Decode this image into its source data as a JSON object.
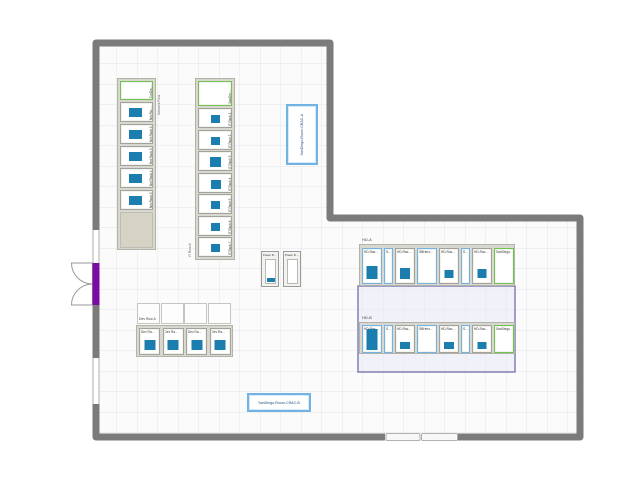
{
  "cracs": {
    "a": "SanDiego-Room-CRAC-A",
    "b": "SanDiego-Room-CRAC-B"
  },
  "network_row": {
    "title": "Network Row",
    "header": "CorDis…",
    "racks": [
      "Net Ra…",
      "Net Rack 2",
      "Net Rack 3",
      "Net Rack 4",
      "Net Rack 5"
    ]
  },
  "it_row": {
    "title": "IT Row A",
    "header": "SanDie…",
    "racks": [
      "IT Rack 1",
      "IT Rack 2",
      "IT Rack 3",
      "IT Rack 4",
      "IT Rack 5",
      "IT Rack 6",
      "IT Rack 7"
    ]
  },
  "power_row": {
    "racks": [
      "Power R…",
      "Power R…"
    ]
  },
  "dev_row": {
    "title": "Dev Row A",
    "racks": [
      "Dev Ra…",
      "Dev Ra…",
      "Dev Ra…",
      "Dev Ra…"
    ]
  },
  "hd_row_a": {
    "title": "HD-A",
    "racks": [
      "HD-Rac…",
      "S…",
      "HD-Rac…",
      "SBHmo…",
      "HD-Rac…",
      "S…",
      "HD-Rac…",
      "SanDiego…"
    ]
  },
  "hd_row_b": {
    "title": "HD-B",
    "racks": [
      "HD-Rac…",
      "S…",
      "HD-Rac…",
      "SBHmo…",
      "HD-Rac…",
      "S…",
      "HD-Rac…",
      "SanDiego…"
    ]
  },
  "colors": {
    "wall": "#7b7b7b",
    "grid_line": "#e4e4e9",
    "device_blue": "#1b7eae",
    "rack_border": "#a3a39c",
    "blue_border": "#73b3e3",
    "green_border": "#71c24e",
    "door_purple": "#7a0ca4",
    "zone_border": "#8181b3",
    "zone_fill": "#e7e9f6",
    "row_fill": "#d9d8d0"
  }
}
